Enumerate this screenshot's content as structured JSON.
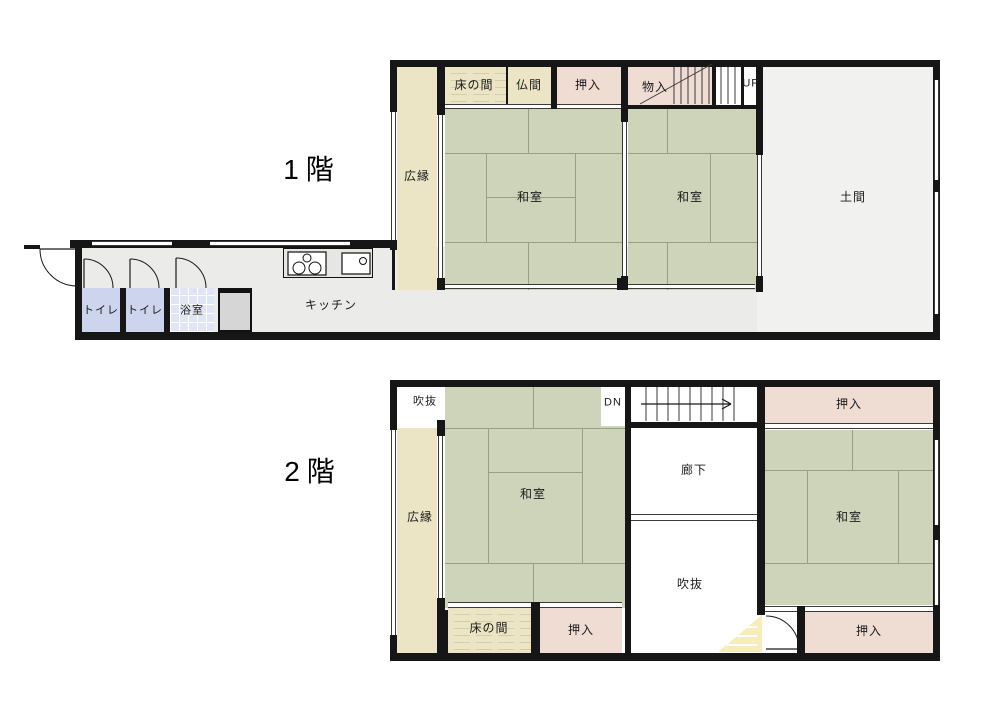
{
  "colors": {
    "wall": "#161616",
    "tatami_green": "#ced4ba",
    "tatami_line": "#98a084",
    "veranda_beige": "#ebe5c5",
    "closet_pink": "#efdcd3",
    "toilet_blue": "#ccd4ee",
    "bath_tile": "#dfe5f4",
    "doma_gray": "#f1f1ef",
    "hall_gray": "#ebebe9",
    "void_highlight_yellow": "#f6edbb"
  },
  "floor1": {
    "title": "1階",
    "labels": {
      "hiroen": "広縁",
      "tokonoma": "床の間",
      "butsuma": "仏間",
      "oshiire": "押入",
      "monoire": "物入",
      "stairs_up": "UP",
      "washitsu_left": "和室",
      "washitsu_right": "和室",
      "doma": "土間",
      "toilet_1": "トイレ",
      "toilet_2": "トイレ",
      "bathroom": "浴室",
      "kitchen": "キッチン"
    }
  },
  "floor2": {
    "title": "2階",
    "labels": {
      "fukinuke_top": "吹抜",
      "hiroen": "広縁",
      "washitsu_left": "和室",
      "stairs_down": "DN",
      "rouka": "廊下",
      "oshiire_top_right": "押入",
      "washitsu_right": "和室",
      "fukinuke_center": "吹抜",
      "tokonoma": "床の間",
      "oshiire_bottom_left": "押入",
      "oshiire_bottom_right": "押入"
    }
  }
}
